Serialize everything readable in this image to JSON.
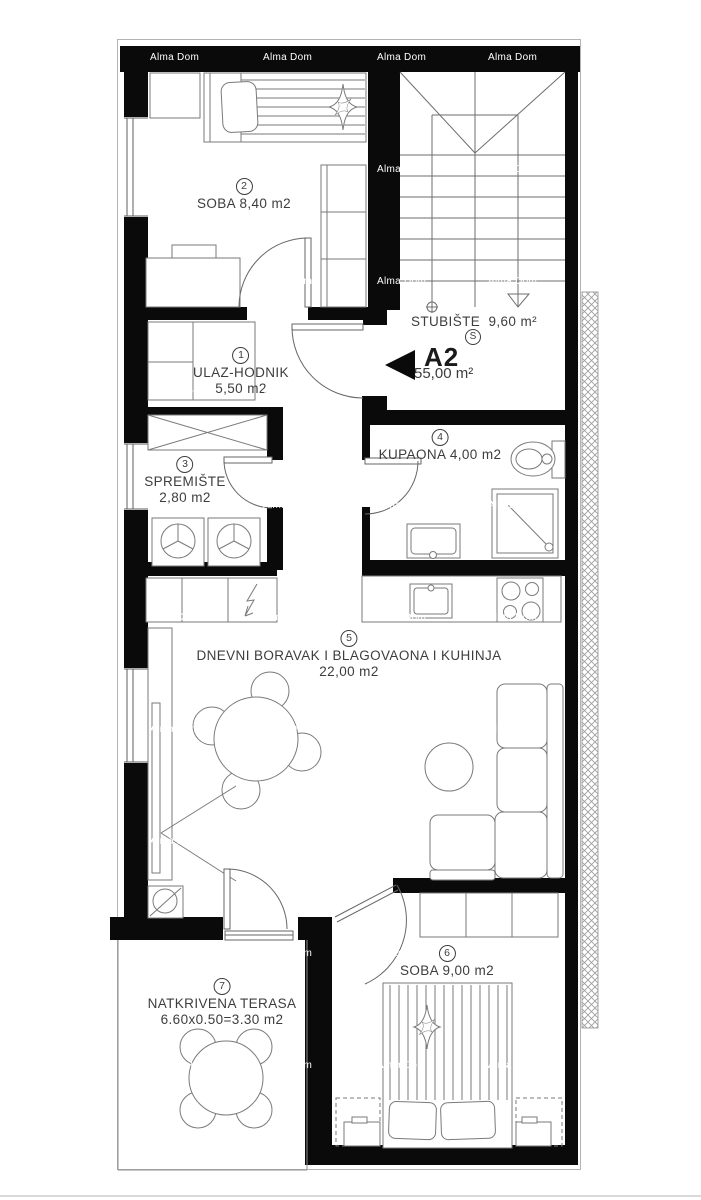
{
  "watermark": {
    "text": "Alma Dom"
  },
  "unit_marker": {
    "code": "A2",
    "area": "55,00 m²"
  },
  "staircase": {
    "label": "STUBIŠTE  9,60 m²",
    "symbol": "S"
  },
  "rooms": [
    {
      "id": "soba-2",
      "number": "2",
      "line1": "SOBA 8,40 m2",
      "line2": ""
    },
    {
      "id": "ulaz",
      "number": "1",
      "line1": "ULAZ-HODNIK",
      "line2": "5,50 m2"
    },
    {
      "id": "spremiste",
      "number": "3",
      "line1": "SPREMIŠTE",
      "line2": "2,80 m2"
    },
    {
      "id": "kupaona",
      "number": "4",
      "line1": "KUPAONA 4,00 m2",
      "line2": ""
    },
    {
      "id": "dnevni",
      "number": "5",
      "line1": "DNEVNI BORAVAK I BLAGOVAONA I KUHINJA",
      "line2": "22,00 m2"
    },
    {
      "id": "soba-6",
      "number": "6",
      "line1": "SOBA 9,00 m2",
      "line2": ""
    },
    {
      "id": "terasa",
      "number": "7",
      "line1": "NATKRIVENA TERASA",
      "line2": "6.60x0.50=3.30 m2"
    }
  ]
}
